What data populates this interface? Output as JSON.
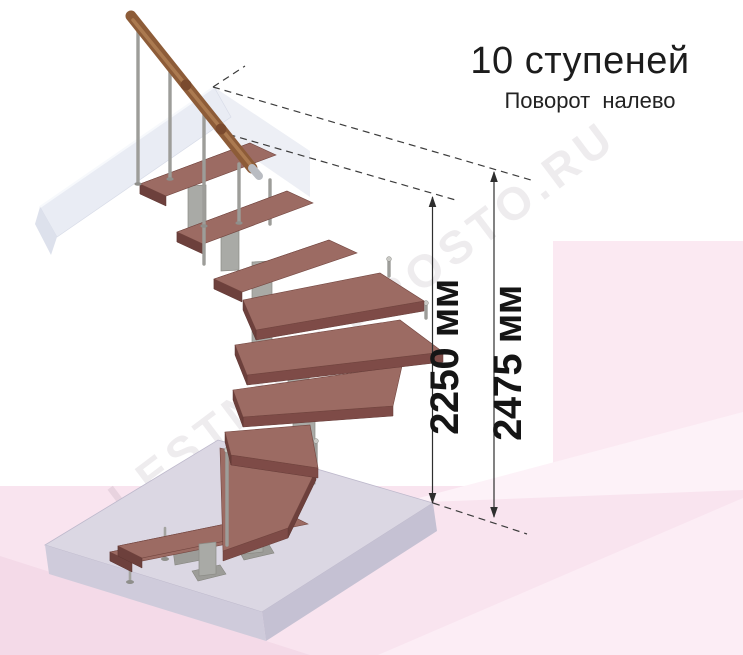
{
  "header": {
    "title": "10 ступеней",
    "subtitle": "Поворот налево"
  },
  "dimensions": {
    "inner": {
      "label": "2250 мм",
      "value": 2250,
      "unit": "мм"
    },
    "overall": {
      "label": "2475 мм",
      "value": 2475,
      "unit": "мм"
    }
  },
  "staircase": {
    "steps_total": 10,
    "turn_direction": "налево"
  },
  "watermark": {
    "text": "LESTNICY-PROSTO.RU"
  },
  "colors": {
    "tread_top": "#9c6b63",
    "tread_front": "#7e4b47",
    "tread_end": "#6d403c",
    "metal": "#a9aaa6",
    "handrail_wood": "#8d5c38",
    "floor_top": "#dbd7e3",
    "beam_white": "#e9ecf4",
    "background_pink": "#f9e4ef",
    "dimension_line": "#2e2e2e",
    "text": "#1c1c1c"
  }
}
